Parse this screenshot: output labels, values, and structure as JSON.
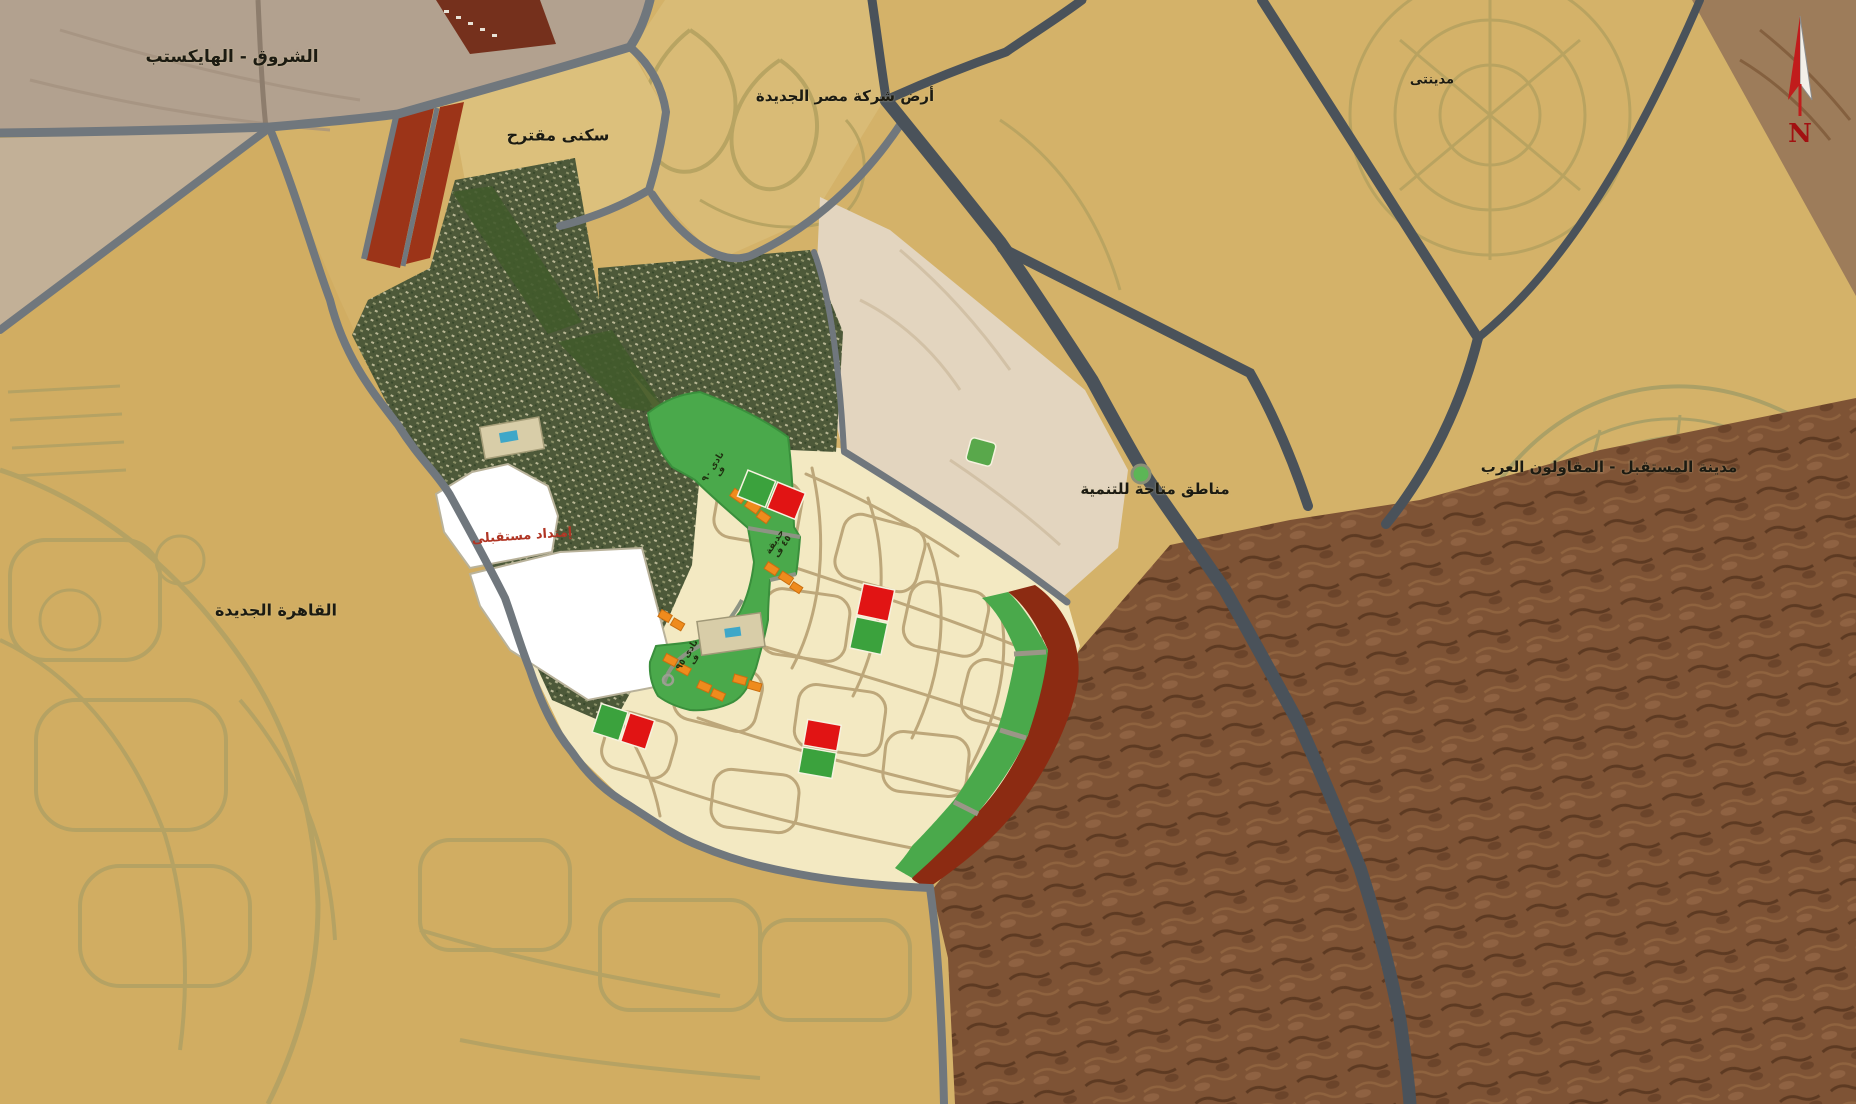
{
  "labels": {
    "shorouk": "الشروق - الهايكستب",
    "proposed_housing": "سكنى مقترح",
    "misr_company_land": "أرض شركة مصر الجديدة",
    "madinaty": "مدينتى",
    "mostakbal_city": "مدينة المستقبل - المقاولون العرب",
    "new_cairo": "القاهرة الجديدة",
    "development_areas": "مناطق متاحة للتنمية",
    "future_extension": "إمتداد مستقبلى",
    "club_90": "نادى ٩٠ ف",
    "garden_45": "حديقة ٤٥ ف",
    "club_95": "نادى ٩٥ ف"
  },
  "compass": {
    "letter": "N"
  },
  "colors": {
    "sand": "#d4b269",
    "grayland": "#b2a18f",
    "road": "#70777d",
    "highway": "#4a525a",
    "residential_dark": "#4d5939",
    "park_green": "#4aa94b",
    "cream_parcels": "#f3e9c2",
    "maroon_strip": "#9c3418",
    "white_extension": "#ffffff",
    "beige_open_land": "#e3d5bf",
    "rocky_desert": "#7e5335",
    "orange_services": "#ef8b1d",
    "red_parcel": "#e11414",
    "label_red": "#b03524"
  }
}
